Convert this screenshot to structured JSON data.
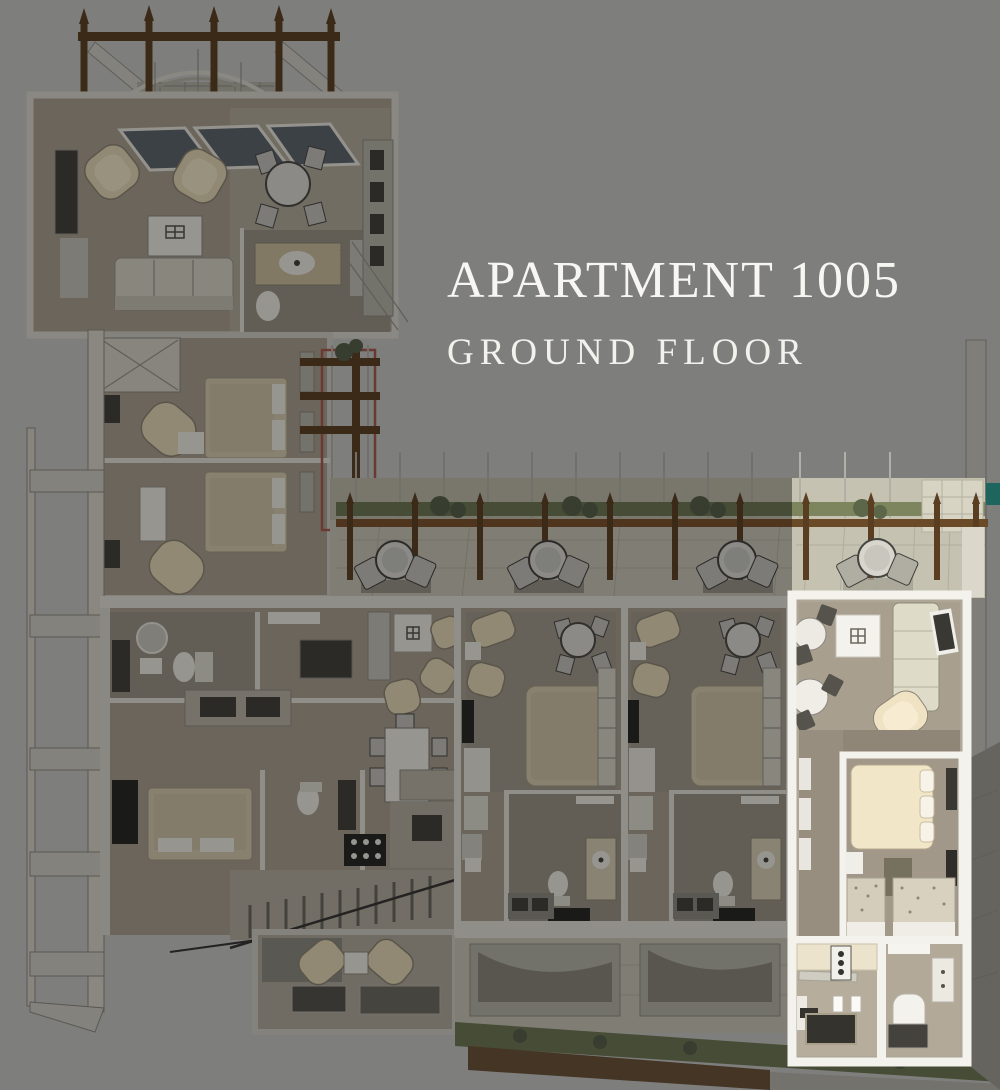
{
  "title": {
    "main": "APARTMENT 1005",
    "subtitle": "GROUND FLOOR"
  },
  "scene": {
    "kind": "3D cutaway floor-plan rendering of an apartment building",
    "floor_label": "Ground floor",
    "highlighted_unit": "Apartment 1005 — lower-right unit, outlined in white and shown at full brightness",
    "dimmed_area": "All other units, terraces and the pergola are dimmed gray",
    "colors": {
      "background": "#7d7d7c",
      "title_text": "#f7f6f2",
      "highlight_wall": "#f4f2ec",
      "highlight_floor": "#b3aa9a",
      "bed_cream": "#f4e7c8",
      "sofa_pale_green": "#dedcc8",
      "pergola_brown": "#5e4326",
      "hedge_green": "#6e7854",
      "counter_dark": "#35332e",
      "teal_accent": "#2f9e94"
    },
    "features": [
      "pergola with pointed posts and arched glass canopy above the upper-left unit",
      "upper-left living room: two armchairs, coffee table, sofa, round dining table, bathroom",
      "left wing with two bedrooms and wardrobe",
      "left exterior colonnade walkway with cross beams",
      "vine trellis with red frame beside the wing",
      "long shared terrace with railing, planters and four bistro table sets",
      "lower row of units: two-bedroom unit with staircase lounge, two identical studio units, and highlighted unit 1005",
      "unit 1005 interior: living room with round tables / sofa / TV, bedroom with double bed and dressers, kitchen with dark counters, bathroom with tub",
      "garden hedge and path strip along the bottom terrace"
    ]
  }
}
